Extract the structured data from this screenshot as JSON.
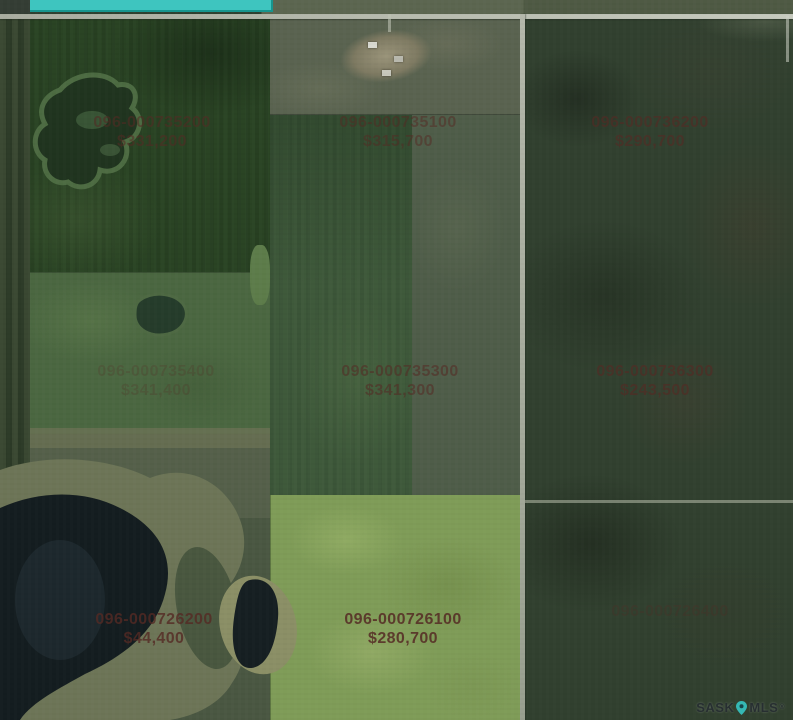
{
  "map": {
    "label_color": "#552a24",
    "selection_color": "#3ec5bf",
    "selection_border": "#17958e",
    "parcels": [
      {
        "id": "096-000735200",
        "price": "$331,200",
        "x": 152,
        "y": 113,
        "opacity": 0.55
      },
      {
        "id": "096-000735100",
        "price": "$315,700",
        "x": 398,
        "y": 113,
        "opacity": 0.5
      },
      {
        "id": "096-000736200",
        "price": "$290,700",
        "x": 650,
        "y": 113,
        "opacity": 0.6
      },
      {
        "id": "096-000735400",
        "price": "$341,400",
        "x": 156,
        "y": 362,
        "opacity": 0.22
      },
      {
        "id": "096-000735300",
        "price": "$341,300",
        "x": 400,
        "y": 362,
        "opacity": 0.55
      },
      {
        "id": "096-000736300",
        "price": "$243,500",
        "x": 655,
        "y": 362,
        "opacity": 0.62
      },
      {
        "id": "096-000726200",
        "price": "$44,400",
        "x": 154,
        "y": 610,
        "opacity": 0.8
      },
      {
        "id": "096-000726100",
        "price": "$280,700",
        "x": 403,
        "y": 610,
        "opacity": 0.85
      },
      {
        "id": "096-000726400",
        "price": "",
        "x": 670,
        "y": 602,
        "opacity": 0.25
      }
    ],
    "watermark": {
      "sask": "SASK",
      "mls": "MLS",
      "reg": "®",
      "pin_color": "#35b8b4"
    }
  }
}
